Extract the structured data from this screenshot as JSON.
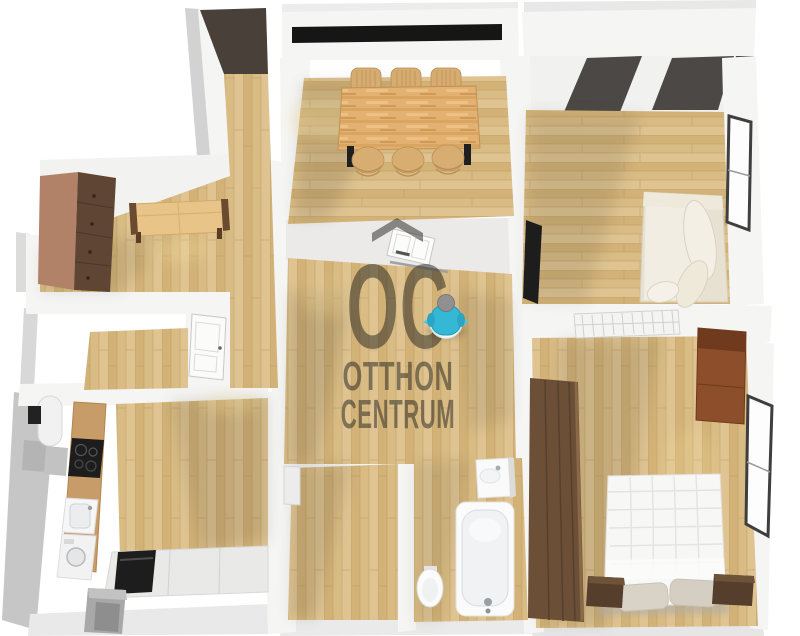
{
  "brand": {
    "watermark_monogram": "OC",
    "watermark_line1": "OTTHON",
    "watermark_line2": "CENTRUM"
  },
  "palette": {
    "background": "#ffffff",
    "wall": "#f5f5f4",
    "wall_shade": "#d2d2d2",
    "floor_plank_light": "#dfc492",
    "floor_plank_mid": "#d9bc84",
    "floor_plank_dark": "#d2b277",
    "entry_mat": "#49403a",
    "ceiling_beam": "#4b4845",
    "dark_wood_furniture": "#5f4533",
    "red_wood_cabinet": "#8d4e2c",
    "table_wood": "#e3b273",
    "sofa_cream": "#f1ede2",
    "watermark_gray": "#23221e",
    "avatar_shirt": "#35b7d6",
    "avatar_head": "#909090",
    "appliance_black": "#1d1d1d"
  }
}
